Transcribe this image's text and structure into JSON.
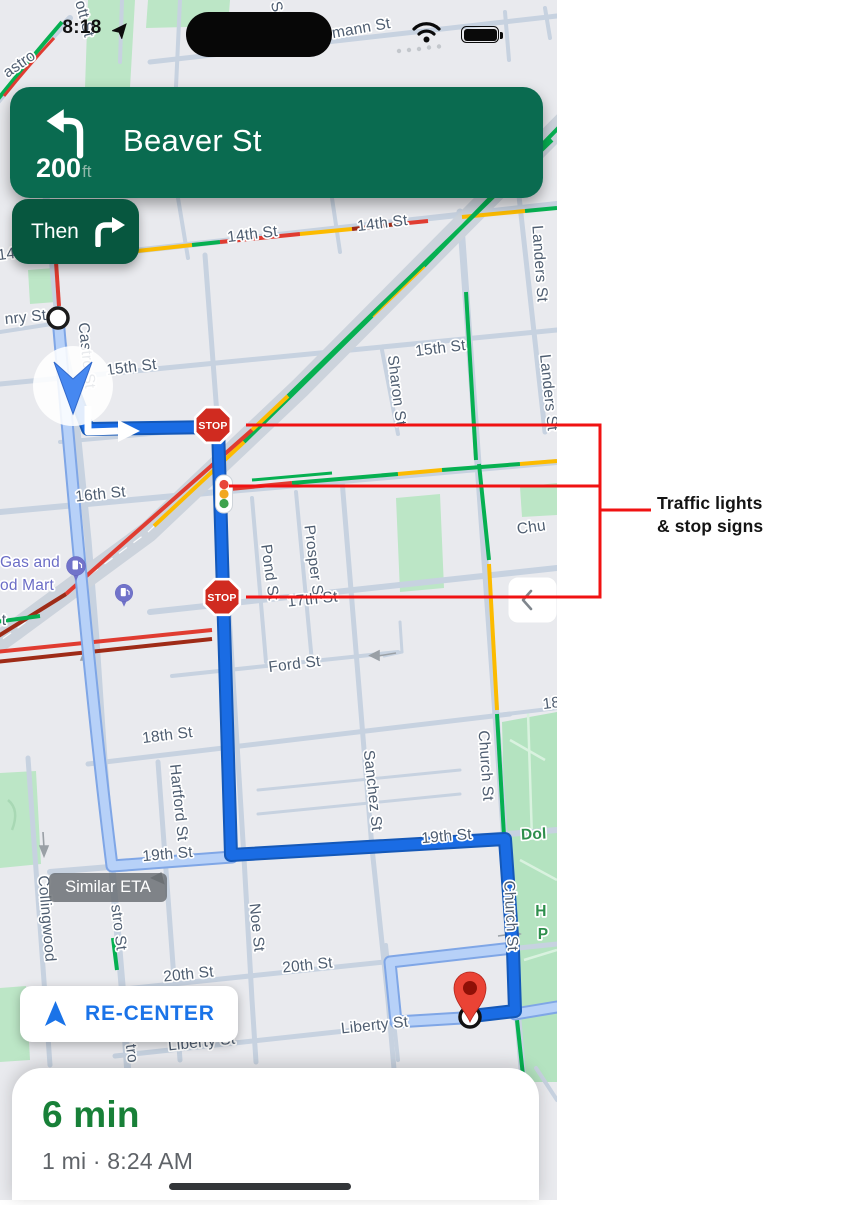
{
  "status_bar": {
    "time": "8:18"
  },
  "banner": {
    "distance": "200",
    "unit": "ft",
    "street": "Beaver St",
    "then_label": "Then"
  },
  "map": {
    "stop_sign_label": "STOP",
    "similar_eta_label": "Similar ETA",
    "recenter_label": "RE-CENTER",
    "labels": [
      {
        "text": "mann St"
      },
      {
        "text": "ott St"
      },
      {
        "text": "astro"
      },
      {
        "text": "S"
      },
      {
        "text": "14th St"
      },
      {
        "text": "14th St"
      },
      {
        "text": "nry St"
      },
      {
        "text": "15th St"
      },
      {
        "text": "15th St"
      },
      {
        "text": "Sharon St"
      },
      {
        "text": "Landers St"
      },
      {
        "text": "Landers St"
      },
      {
        "text": "16th St"
      },
      {
        "text": "Pond St"
      },
      {
        "text": "Prosper St"
      },
      {
        "text": "17th St"
      },
      {
        "text": "Ford St"
      },
      {
        "text": "18th St"
      },
      {
        "text": "18"
      },
      {
        "text": "Hartford St"
      },
      {
        "text": "Sanchez St"
      },
      {
        "text": "Church St"
      },
      {
        "text": "Church St"
      },
      {
        "text": "19th St"
      },
      {
        "text": "19th St"
      },
      {
        "text": "Collingwood"
      },
      {
        "text": "stro St"
      },
      {
        "text": "Noe St"
      },
      {
        "text": "20th St"
      },
      {
        "text": "20th St"
      },
      {
        "text": "Liberty St"
      },
      {
        "text": "Liberty St"
      },
      {
        "text": "tro"
      },
      {
        "text": "Gas and"
      },
      {
        "text": "od Mart"
      },
      {
        "text": "Chu"
      },
      {
        "text": "Dol"
      },
      {
        "text": "H"
      },
      {
        "text": "P"
      },
      {
        "text": "Castro St"
      },
      {
        "text": "t"
      },
      {
        "text": "14"
      }
    ]
  },
  "annotation": {
    "line1": "Traffic lights",
    "line2": "& stop signs"
  },
  "bottom_card": {
    "eta": "6 min",
    "details": "1 mi · 8:24 AM"
  },
  "colors": {
    "banner_green": "#0a6b50",
    "then_green": "#07573f",
    "route_blue": "#1a6ce4",
    "alt_route_blue": "#b7d1f8",
    "traffic_green": "#06b051",
    "traffic_yellow": "#fcbb00",
    "traffic_red": "#e03c31",
    "traffic_dark_red": "#9e2b17",
    "annotation_red": "#f01212",
    "eta_green": "#188038",
    "recenter_blue": "#1a73e8"
  }
}
